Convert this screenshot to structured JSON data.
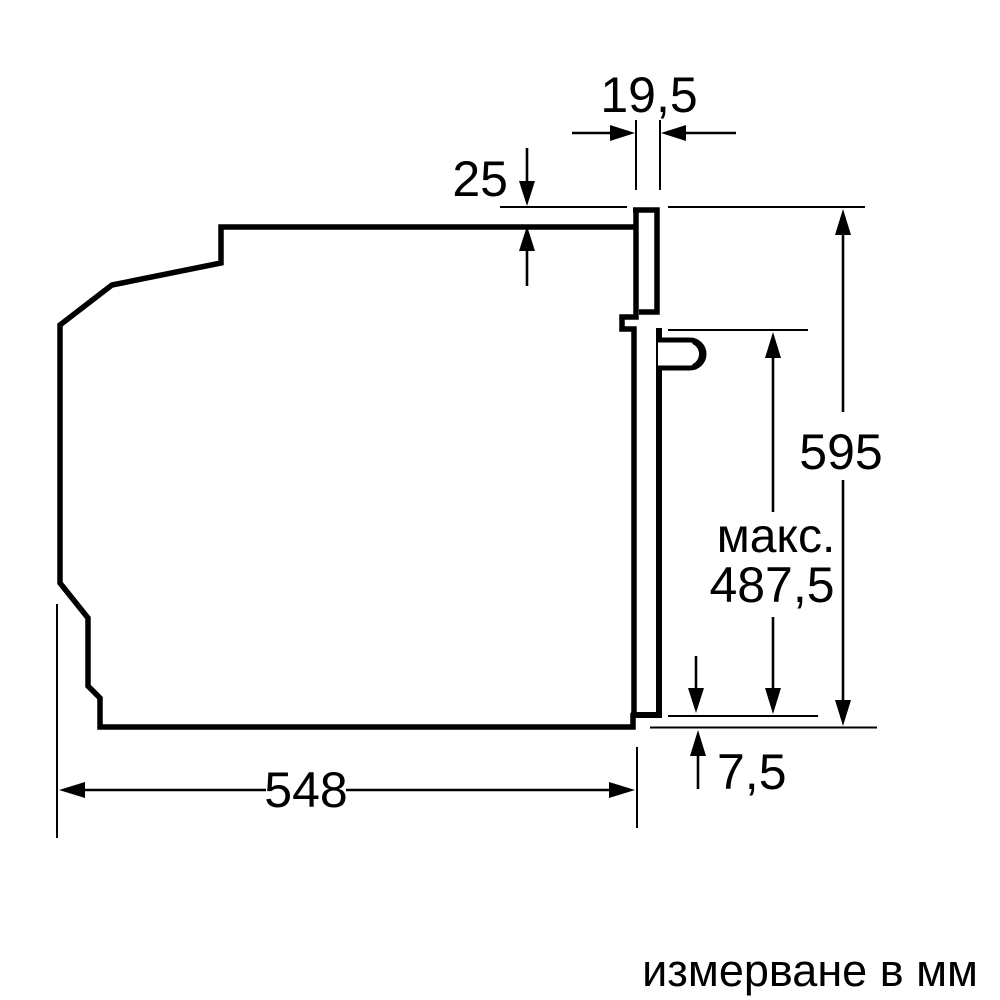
{
  "diagram": {
    "title": "oven-installation-side-view",
    "unit_note": "измерване в мм",
    "colors": {
      "line": "#000000",
      "background": "#ffffff"
    },
    "dims": {
      "door_front": "19,5",
      "top_inset": "25",
      "height": "595",
      "max_label": "макс.",
      "max_value": "487,5",
      "bottom_gap": "7,5",
      "depth": "548"
    },
    "dimensions_list": [
      {
        "name": "door-front-protrusion",
        "value": "19,5"
      },
      {
        "name": "top-inset",
        "value": "25"
      },
      {
        "name": "appliance-height",
        "value": "595"
      },
      {
        "name": "max-door-opening",
        "value": "макс. 487,5"
      },
      {
        "name": "bottom-gap",
        "value": "7,5"
      },
      {
        "name": "appliance-depth",
        "value": "548"
      }
    ]
  }
}
